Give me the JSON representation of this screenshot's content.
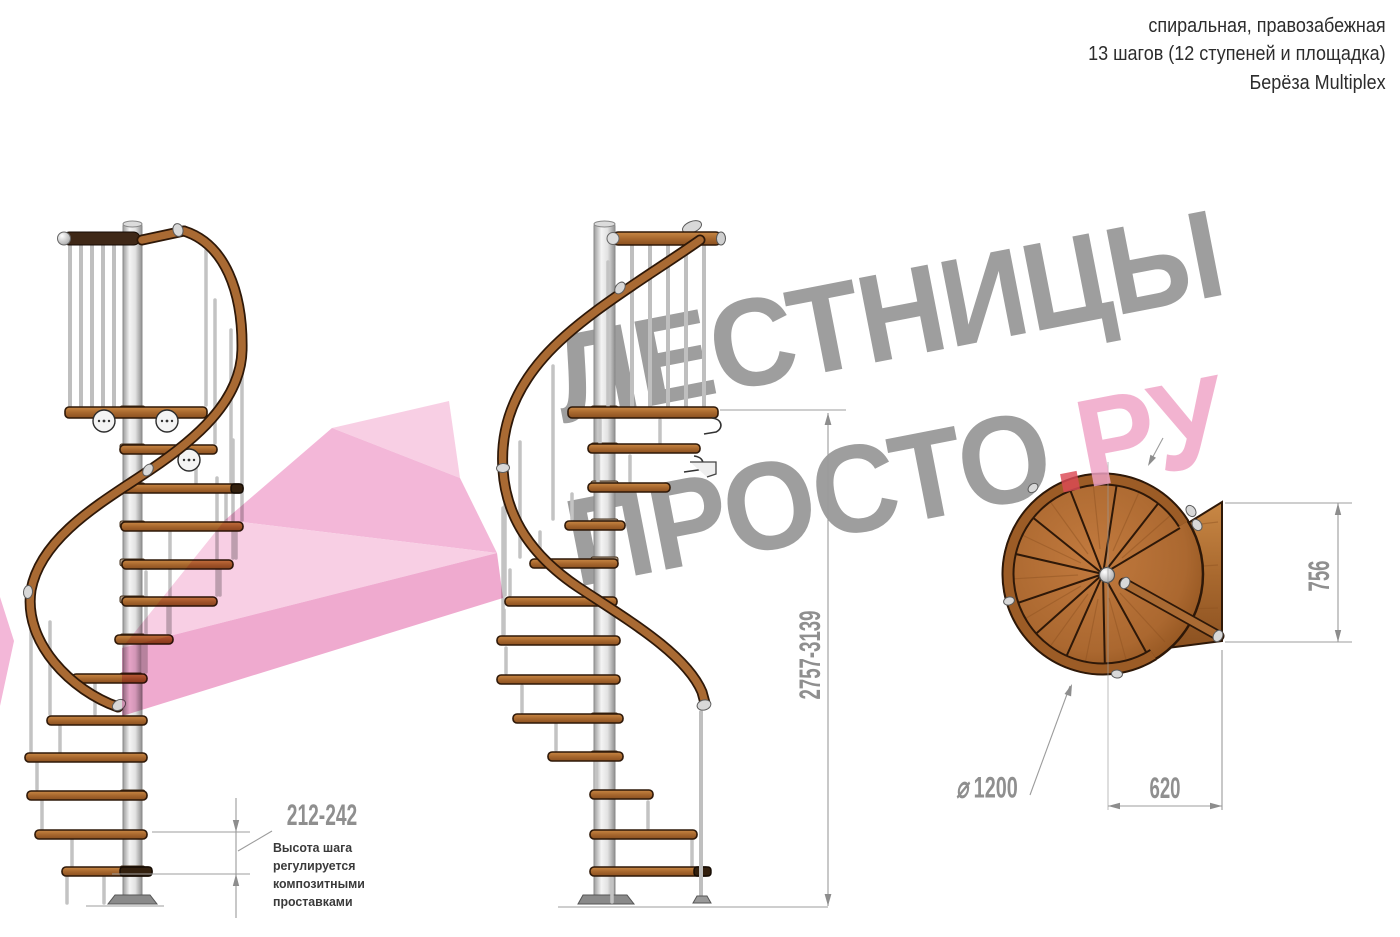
{
  "header": {
    "line1": "спиральная, правозабежная",
    "line2": "13 шагов (12 ступеней и площадка)",
    "line3": "Берёза Multiplex"
  },
  "watermark": {
    "word_top": "ЛЕСТНИЦЫ",
    "word_bottom": "ПРОСТО",
    "dot": ".",
    "word_domain": "РУ"
  },
  "dimensions": {
    "total_height_range_mm": "2757-3139",
    "step_height_range_mm": "212-242",
    "step_height_note_lines": [
      "Высота шага",
      "регулируется",
      "композитными",
      "проставками"
    ],
    "landing_side_mm": "756",
    "landing_width_mm": "620",
    "diameter_symbol": "⌀",
    "diameter_mm": "1200"
  },
  "colors": {
    "wood": "#a8682e",
    "wood_light": "#c98845",
    "wood_dark": "#8a5020",
    "outline": "#2e1808",
    "metal": "#e6e6e6",
    "metal_dark": "#8f8f8f",
    "dim_line": "#9c9c9c",
    "dim_text": "#8f8f8f",
    "note_text": "#3a3a3a",
    "header_text": "#2c2c2c",
    "wm_gray": "#9e9e9e",
    "wm_pink": "#f0a3c6",
    "wm_red": "#dc4a55",
    "arrow_light": "#f8cfe4",
    "arrow_mid": "#f3b7d8",
    "arrow_deep": "#efaacf"
  }
}
